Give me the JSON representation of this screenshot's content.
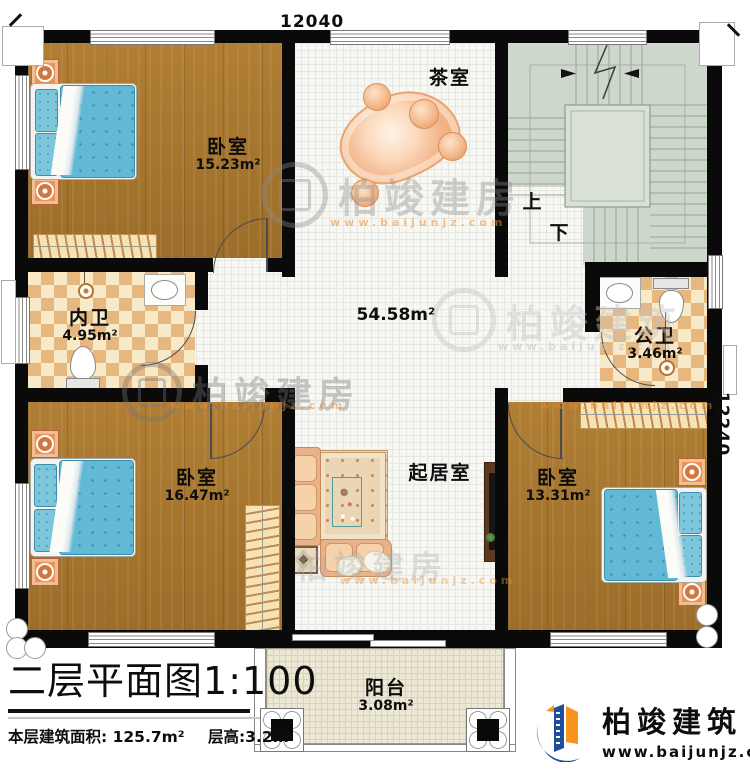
{
  "plan": {
    "dim_top": "12040",
    "dim_right": "12240",
    "rooms": {
      "bedroom_tl": {
        "name": "卧室",
        "area": "15.23m²"
      },
      "bedroom_bl": {
        "name": "卧室",
        "area": "16.47m²"
      },
      "bedroom_br": {
        "name": "卧室",
        "area": "13.31m²"
      },
      "tea_room": {
        "name": "茶室"
      },
      "inner_bath": {
        "name": "内卫",
        "area": "4.95m²"
      },
      "public_bath": {
        "name": "公卫",
        "area": "3.46m²"
      },
      "hall_area": "54.58m²",
      "living_room": {
        "name": "起居室"
      },
      "balcony": {
        "name": "阳台",
        "area": "3.08m²"
      },
      "stairs": {
        "up": "上",
        "down": "下"
      }
    }
  },
  "title_block": {
    "title": "二层平面图",
    "scale": "1:100",
    "floor_area_label": "本层建筑面积: 125.7m²",
    "floor_height_label": "层高:3.2m"
  },
  "branding": {
    "company": "柏竣建筑",
    "website": "www.baijunjz.com",
    "stroke_mark": "、",
    "logo_blue": "#1d4f9e",
    "logo_orange": "#f7941d"
  },
  "watermarks": [
    {
      "text": "柏竣建房",
      "sub": "www.baijunjz.com"
    },
    {
      "text": "柏竣建筑",
      "sub": "www.baijunjz.com"
    },
    {
      "text": "柏竣建房",
      "sub": "www.baijunjz.com"
    },
    {
      "text": "柏竣建房",
      "sub": "www.baijunjz.com"
    }
  ],
  "palette": {
    "wall": "#0a0a0a",
    "wood": "#a5762e",
    "hall_tile": "#f7f7f4",
    "bath_checker": "#e6b77f",
    "stairs": "#cdd7cb",
    "balcony": "#ece8d3",
    "bed_blue": "#62b9d5",
    "sofa_tan": "#eab288"
  }
}
